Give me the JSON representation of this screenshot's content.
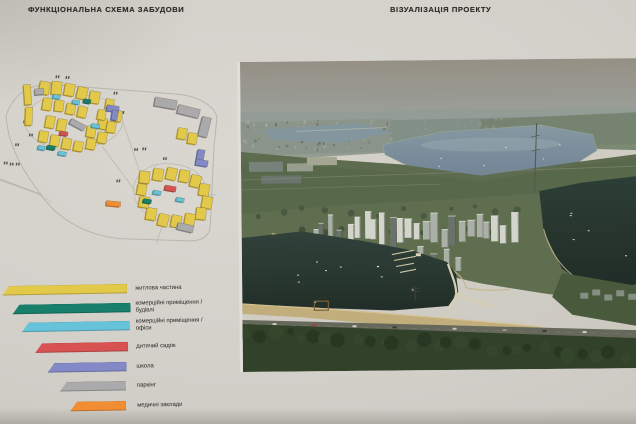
{
  "board": {
    "left_title": "ФУНКЦІОНАЛЬНА СХЕМА ЗАБУДОВИ",
    "right_title": "ВІЗУАЛІЗАЦІЯ ПРОЕКТУ"
  },
  "legend": {
    "items": [
      {
        "lines": [
          "житлова частина"
        ],
        "color": "#e3c94a"
      },
      {
        "lines": [
          "комерційні приміщення /",
          "будівлі"
        ],
        "color": "#187f6b"
      },
      {
        "lines": [
          "комерційні приміщення /",
          "офіси"
        ],
        "color": "#67c3d9"
      },
      {
        "lines": [
          "дитячий садок"
        ],
        "color": "#d95252"
      },
      {
        "lines": [
          "школа"
        ],
        "color": "#8289c6"
      },
      {
        "lines": [
          "паркінг"
        ],
        "color": "#aaaaac"
      },
      {
        "lines": [
          "медичні заклади"
        ],
        "color": "#f18d33"
      }
    ]
  }
}
